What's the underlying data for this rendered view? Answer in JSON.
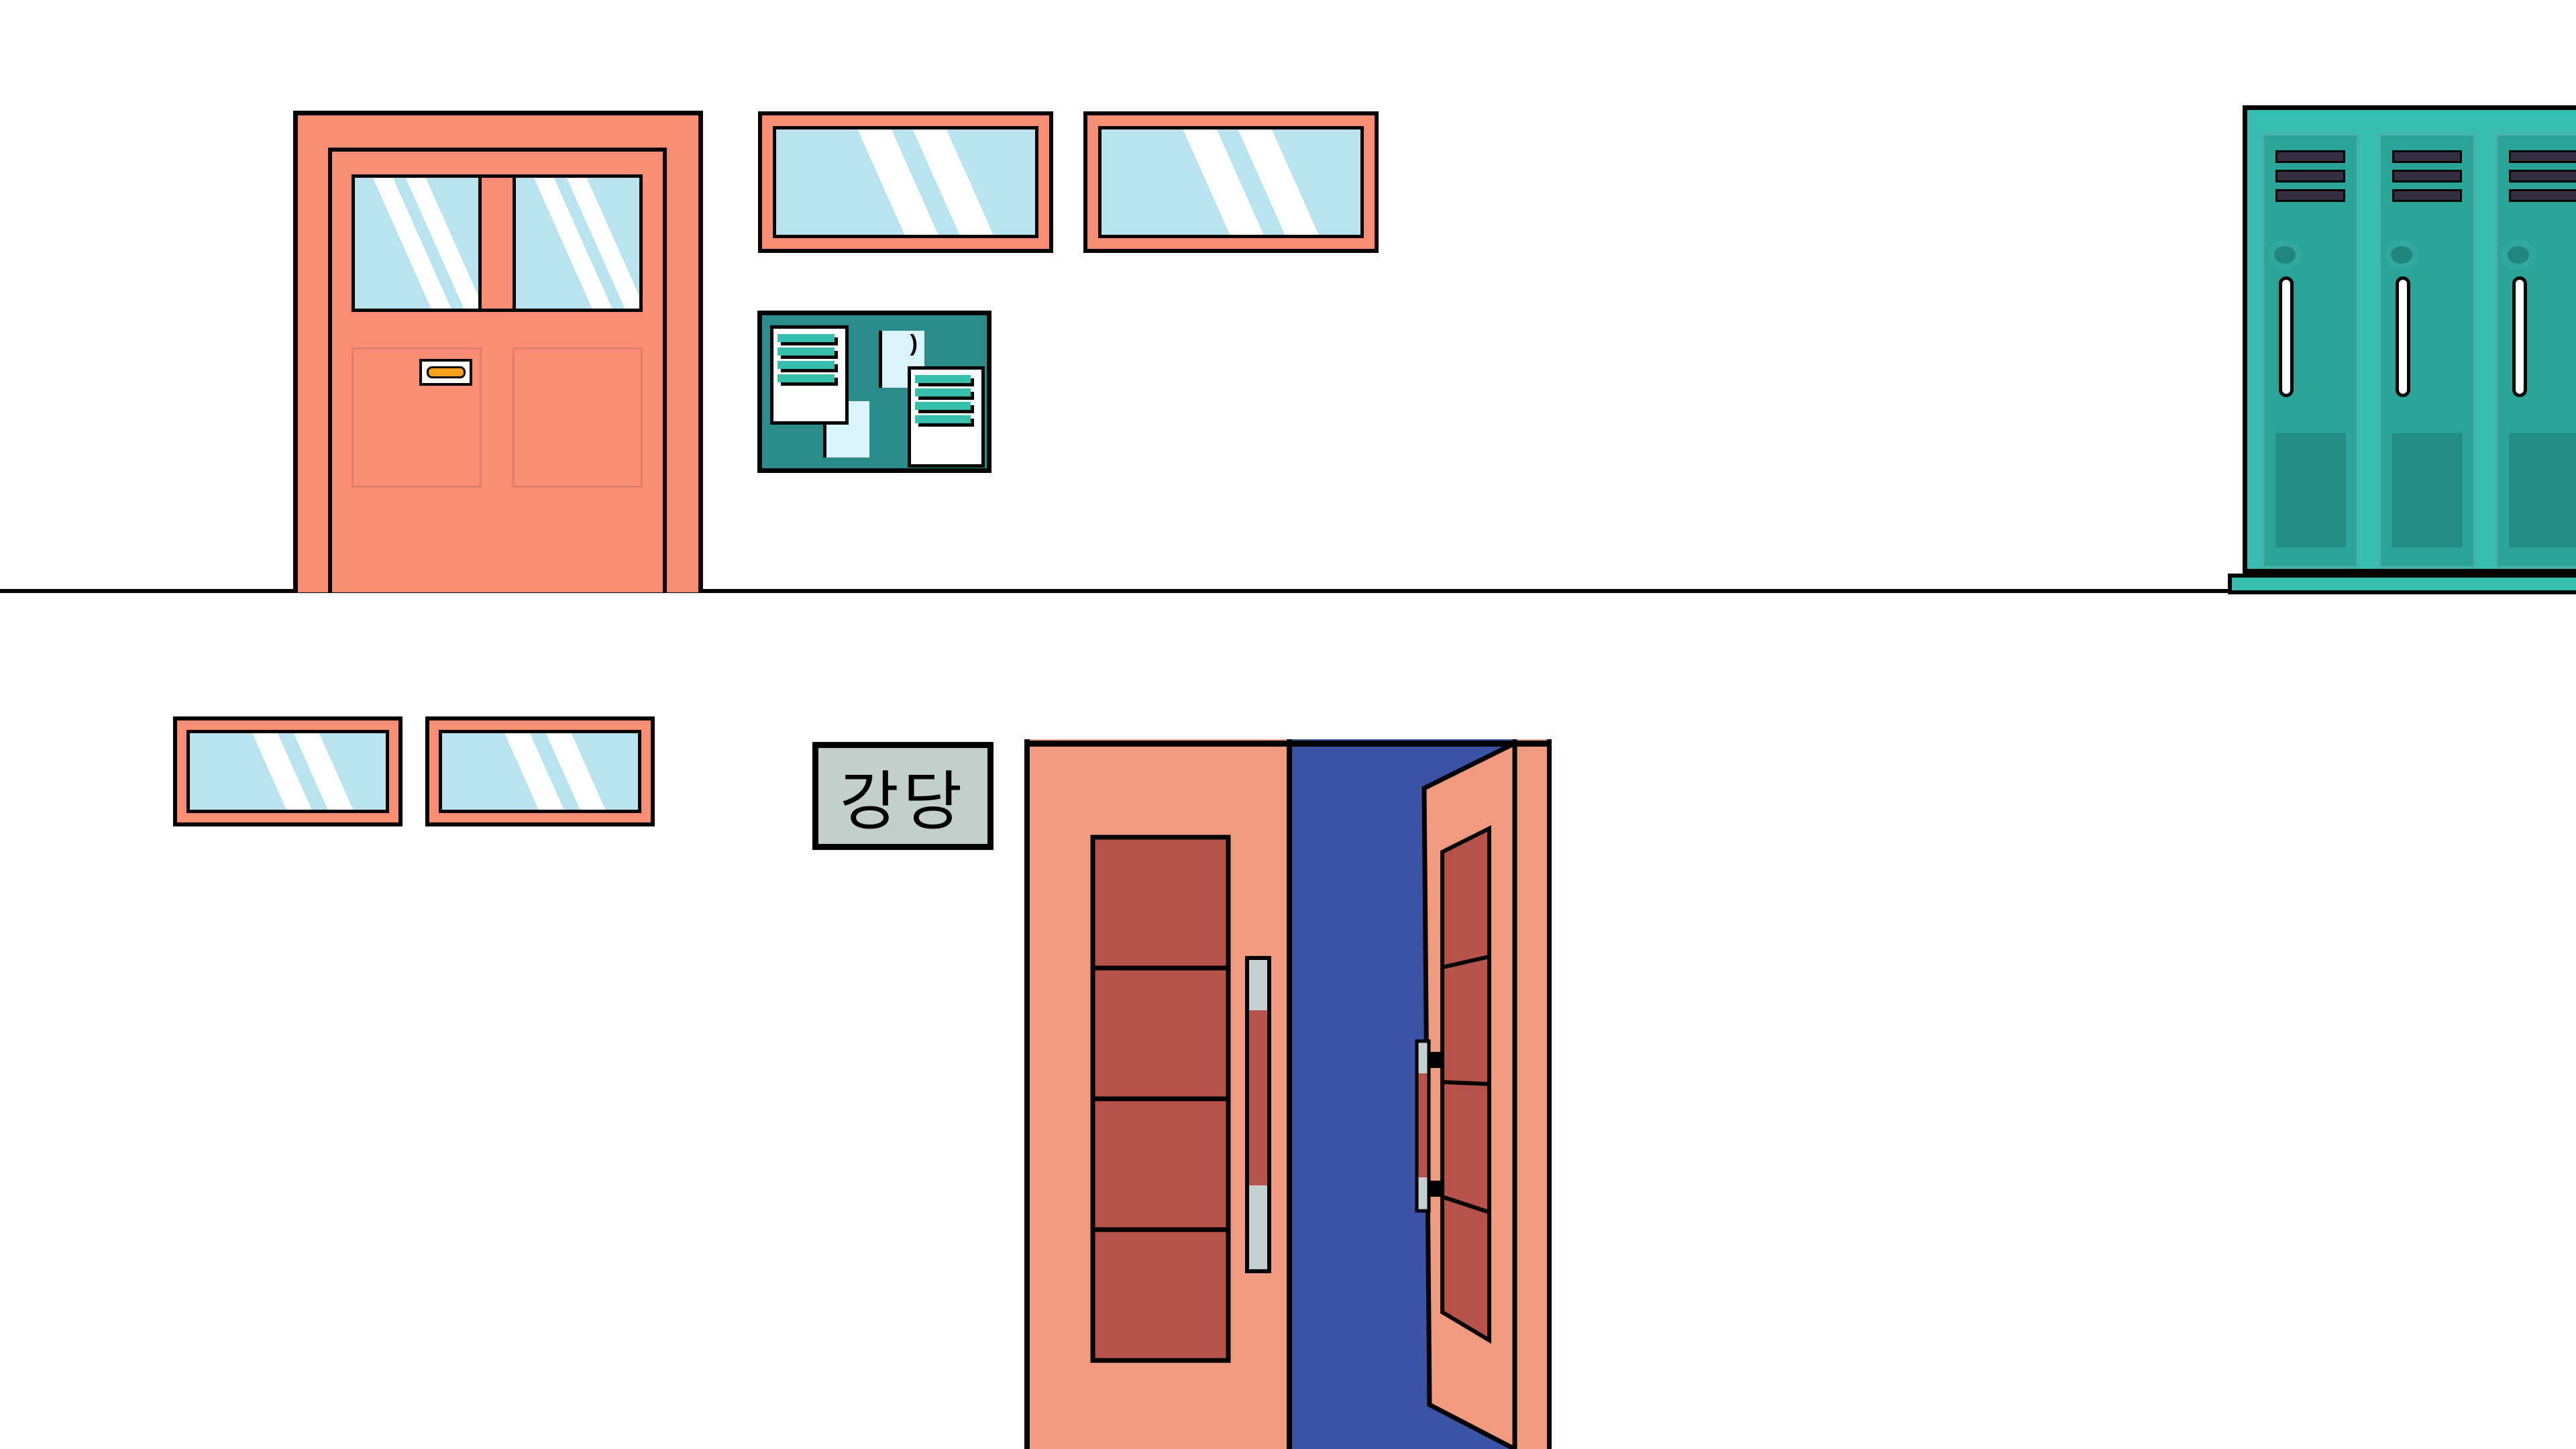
{
  "colors": {
    "background": "#FFFFFF",
    "outline": "#000000",
    "salmon_bright": "#FB8D75",
    "salmon_soft": "#DE8069",
    "salmon_muted": "#F09B80",
    "dark_red": "#B5524A",
    "royal_blue": "#3A53A4",
    "glass_blue": "#B9E4EF",
    "glass_white": "#FFFFFF",
    "board_teal": "#2A8C8B",
    "stripe_teal": "#36BFAD",
    "paper_cyan": "#D9F4F8",
    "locker_body": "#36BDB0",
    "locker_door": "#2AA399",
    "locker_door_stroke": "#49B2A8",
    "locker_panel": "#238C85",
    "lock_outer": "#31A89D",
    "lock_inner": "#20857C",
    "vent_dark": "#332E40",
    "handle_gray": "#C5D1D0",
    "sign_bg": "#C3CFCA",
    "plate_orange": "#F6A21D"
  },
  "scene": {
    "upper_hallway": {
      "classroom_door": {
        "windows": 2,
        "panels": 2,
        "nameplate": true
      },
      "transom_windows": 2,
      "bulletin_board": {
        "white_notes": 2,
        "cyan_notes": 2,
        "lines_per_white_note": 4,
        "pin_mark_glyph": ")"
      },
      "lockers": {
        "count": 3,
        "vents_per_locker": 3
      }
    },
    "lower_hallway": {
      "transom_windows": 2,
      "sign": {
        "label": "강당"
      },
      "auditorium_door": {
        "left_leaf": "closed",
        "right_leaf": "open",
        "panels_per_leaf": 4
      }
    }
  }
}
